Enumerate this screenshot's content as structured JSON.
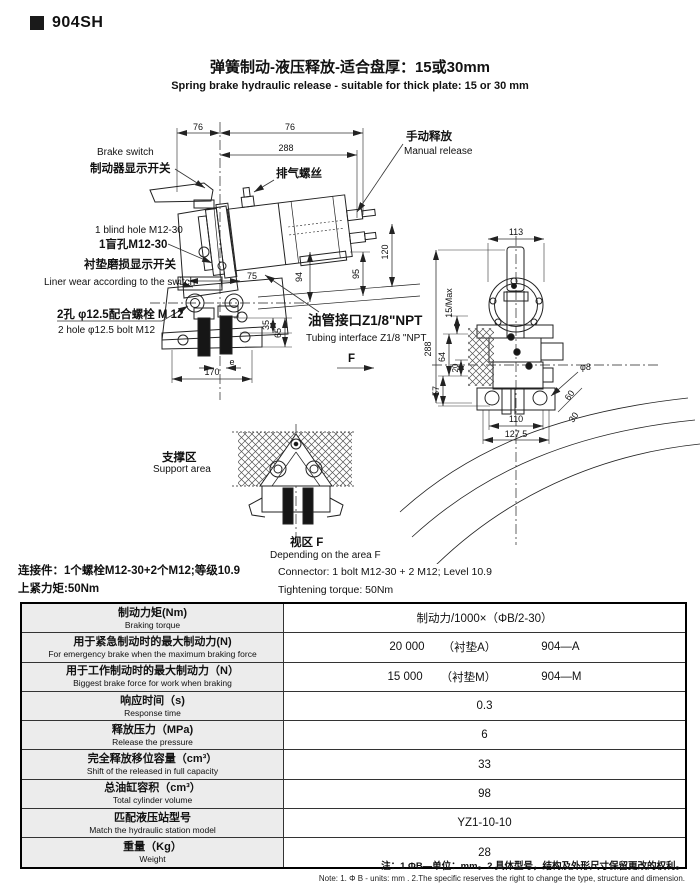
{
  "header": {
    "model": "904SH"
  },
  "title": {
    "zh": "弹簧制动-液压释放-适合盘厚：15或30mm",
    "en": "Spring brake hydraulic release - suitable for thick plate: 15 or 30 mm"
  },
  "drawing": {
    "labels": {
      "brake_switch_en": "Brake switch",
      "brake_switch_zh": "制动器显示开关",
      "exhaust_screw_zh": "排气螺丝",
      "manual_release_zh": "手动释放",
      "manual_release_en": "Manual release",
      "blind_hole_en": "1 blind hole M12-30",
      "blind_hole_zh": "1盲孔M12-30",
      "liner_wear_zh": "衬垫磨损显示开关",
      "liner_wear_en": "Liner wear according to the switch",
      "bolt_zh": "2孔 φ12.5配合螺栓 M 12",
      "bolt_en": "2 hole φ12.5 bolt M12",
      "tubing_zh": "油管接口Z1/8\"NPT",
      "tubing_en": "Tubing interface Z1/8 \"NPT",
      "support_zh": "支撑区",
      "support_en": "Support area",
      "view_zh": "视区 F",
      "view_en": "Depending on the area F",
      "f_arrow": "F"
    },
    "dims": {
      "d76a": "76",
      "d76b": "76",
      "d288": "288",
      "d120": "120",
      "d94": "94",
      "d95": "95",
      "d75": "75",
      "d35": "35",
      "d65": "65",
      "de": "e",
      "d170": "170",
      "d113": "113",
      "d288r": "288",
      "d15max": "15/Max",
      "d64": "64",
      "d20": "20",
      "d57": "57",
      "dphi8": "φ8",
      "d60": "60",
      "d30": "30",
      "d110": "110",
      "d127_5": "127.5"
    }
  },
  "connector": {
    "zh1": "连接件：1个螺栓M12-30+2个M12;等级10.9",
    "zh2": "上紧力矩:50Nm",
    "en1": "Connector: 1 bolt M12-30 + 2 M12; Level 10.9",
    "en2": "Tightening torque: 50Nm"
  },
  "spec_table": {
    "rows": [
      {
        "zh": "制动力矩(Nm)",
        "en": "Braking torque",
        "value": "制动力/1000×（ΦB/2-30）"
      },
      {
        "zh": "用于紧急制动时的最大制动力(N)",
        "en": "For emergency brake when the maximum braking force",
        "parts": [
          "20 000",
          "（衬垫A）",
          "904—A"
        ]
      },
      {
        "zh": "用于工作制动时的最大制动力（N）",
        "en": "Biggest brake force for work when braking",
        "parts": [
          "15 000",
          "（衬垫M）",
          "904—M"
        ]
      },
      {
        "zh": "响应时间（s)",
        "en": "Response time",
        "value": "0.3"
      },
      {
        "zh": "释放压力（MPa)",
        "en": "Release the pressure",
        "value": "6"
      },
      {
        "zh": "完全释放移位容量（cm³）",
        "en": "Shift of the released in full capacity",
        "value": "33"
      },
      {
        "zh": "总油缸容积（cm³）",
        "en": "Total cylinder volume",
        "value": "98"
      },
      {
        "zh": "匹配液压站型号",
        "en": "Match the hydraulic station model",
        "value": "YZ1-10-10"
      },
      {
        "zh": "重量（Kg）",
        "en": "Weight",
        "value": "28"
      }
    ]
  },
  "notes": {
    "zh": "注：1.ΦB—单位：mm。2.具体型号，结构及外形尺寸保留更改的权利。",
    "en": "Note: 1. Φ B - units: mm .  2.The specific reserves the right to change the type, structure and dimension."
  }
}
